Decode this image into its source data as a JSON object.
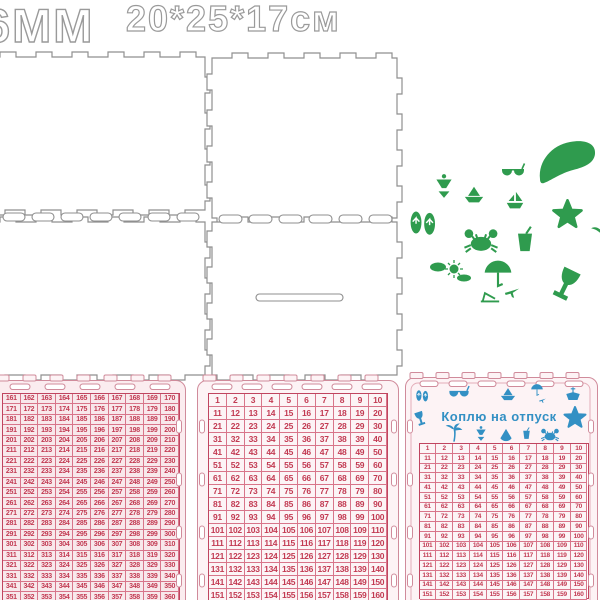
{
  "title": {
    "thickness": "6MM",
    "dimensions": "20*25*17см"
  },
  "box_panels": [
    "lid-panel",
    "top-right-panel",
    "front-panel",
    "back-panel-with-coin-slot"
  ],
  "decor": {
    "green_color": "#2f9b4e",
    "green_icons": [
      "swim-fin",
      "bikini",
      "sunglasses",
      "paper-boat",
      "sailboat",
      "starfish",
      "flip-flops",
      "crab",
      "drink-cup",
      "sun-and-clouds",
      "beach-umbrella",
      "lounger",
      "airplane",
      "cocktail-glass",
      "palm-tree-partial"
    ]
  },
  "plaques": {
    "left": {
      "grid": {
        "start": 161,
        "end": 360,
        "columns": 10
      }
    },
    "middle": {
      "grid": {
        "start": 1,
        "end": 160,
        "columns": 10
      }
    },
    "right": {
      "title": "Коплю на отпуск",
      "teal_color": "#3390c4",
      "header_icons_row1": [
        "flip-flops",
        "sunglasses",
        "paper-boat",
        "umbrella-airplane",
        "ship"
      ],
      "header_icons_sides": [
        "cocktail-glass",
        "starfish"
      ],
      "header_icons_row2": [
        "palm-tree",
        "bikini",
        "shell",
        "drink",
        "crab"
      ],
      "grid": {
        "start": 1,
        "end": 160,
        "columns": 10
      }
    }
  },
  "colors": {
    "number_red": "#c23a52",
    "grid_line": "#d8758a",
    "plaque_pink": "#d08b9b",
    "outline_gray": "#9a9a9a"
  }
}
